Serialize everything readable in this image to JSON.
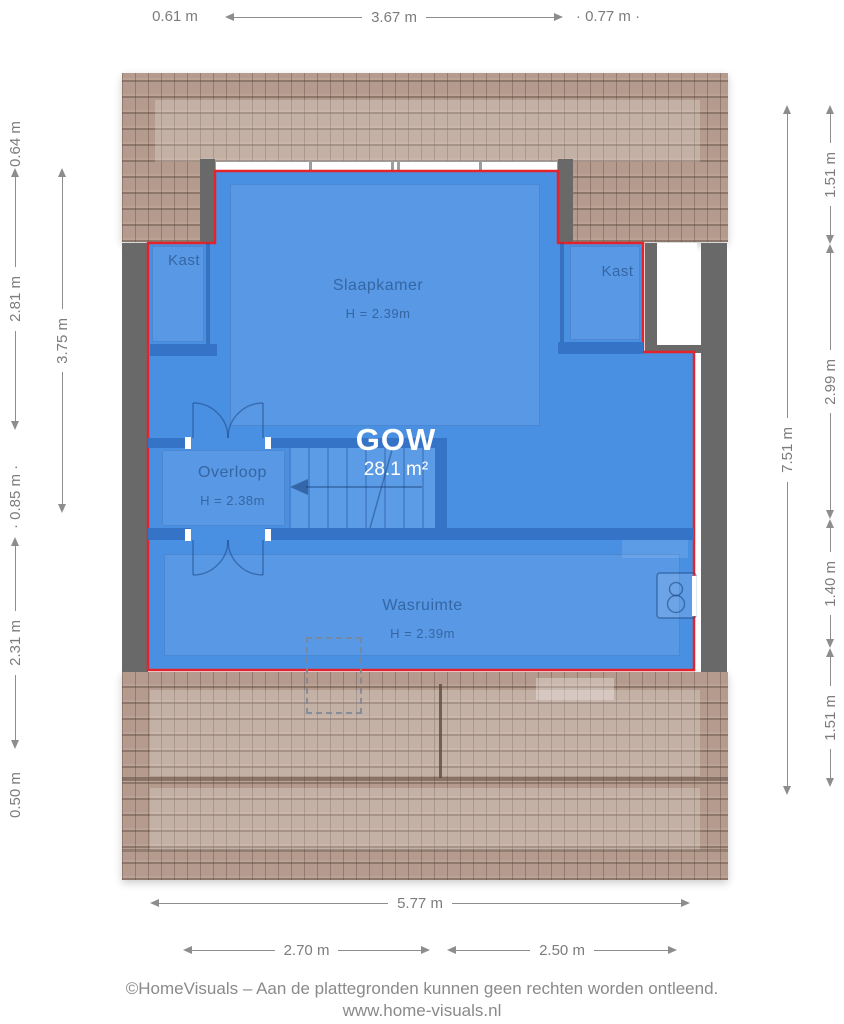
{
  "colors": {
    "floor_blue": "#4a90e2",
    "outline_red": "#e3242b",
    "wall_gray": "#696969",
    "roof_tan": "#b49b8d"
  },
  "rooms": {
    "kast_left": {
      "label": "Kast"
    },
    "slaapkamer": {
      "label": "Slaapkamer",
      "height": "H = 2.39m"
    },
    "kast_right": {
      "label": "Kast"
    },
    "overloop": {
      "label": "Overloop",
      "height": "H = 2.38m"
    },
    "wasruimte": {
      "label": "Wasruimte",
      "height": "H = 2.39m"
    }
  },
  "gow": {
    "label": "GOW",
    "area": "28.1 m²"
  },
  "dimensions": {
    "top": [
      "0.61 m",
      "3.67 m",
      "0.77 m"
    ],
    "left_outer": [
      "0.64 m",
      "2.81 m",
      "0.85 m",
      "2.31 m",
      "0.50 m"
    ],
    "left_inner": [
      "3.75 m"
    ],
    "right_inner": [
      "7.51 m"
    ],
    "right_outer": [
      "1.51 m",
      "2.99 m",
      "1.40 m",
      "1.51 m"
    ],
    "bottom_total": "5.77 m",
    "bottom_split": [
      "2.70 m",
      "2.50 m"
    ]
  },
  "footer": {
    "line1": "©HomeVisuals – Aan de plattegronden kunnen geen rechten worden ontleend.",
    "line2": "www.home-visuals.nl"
  }
}
